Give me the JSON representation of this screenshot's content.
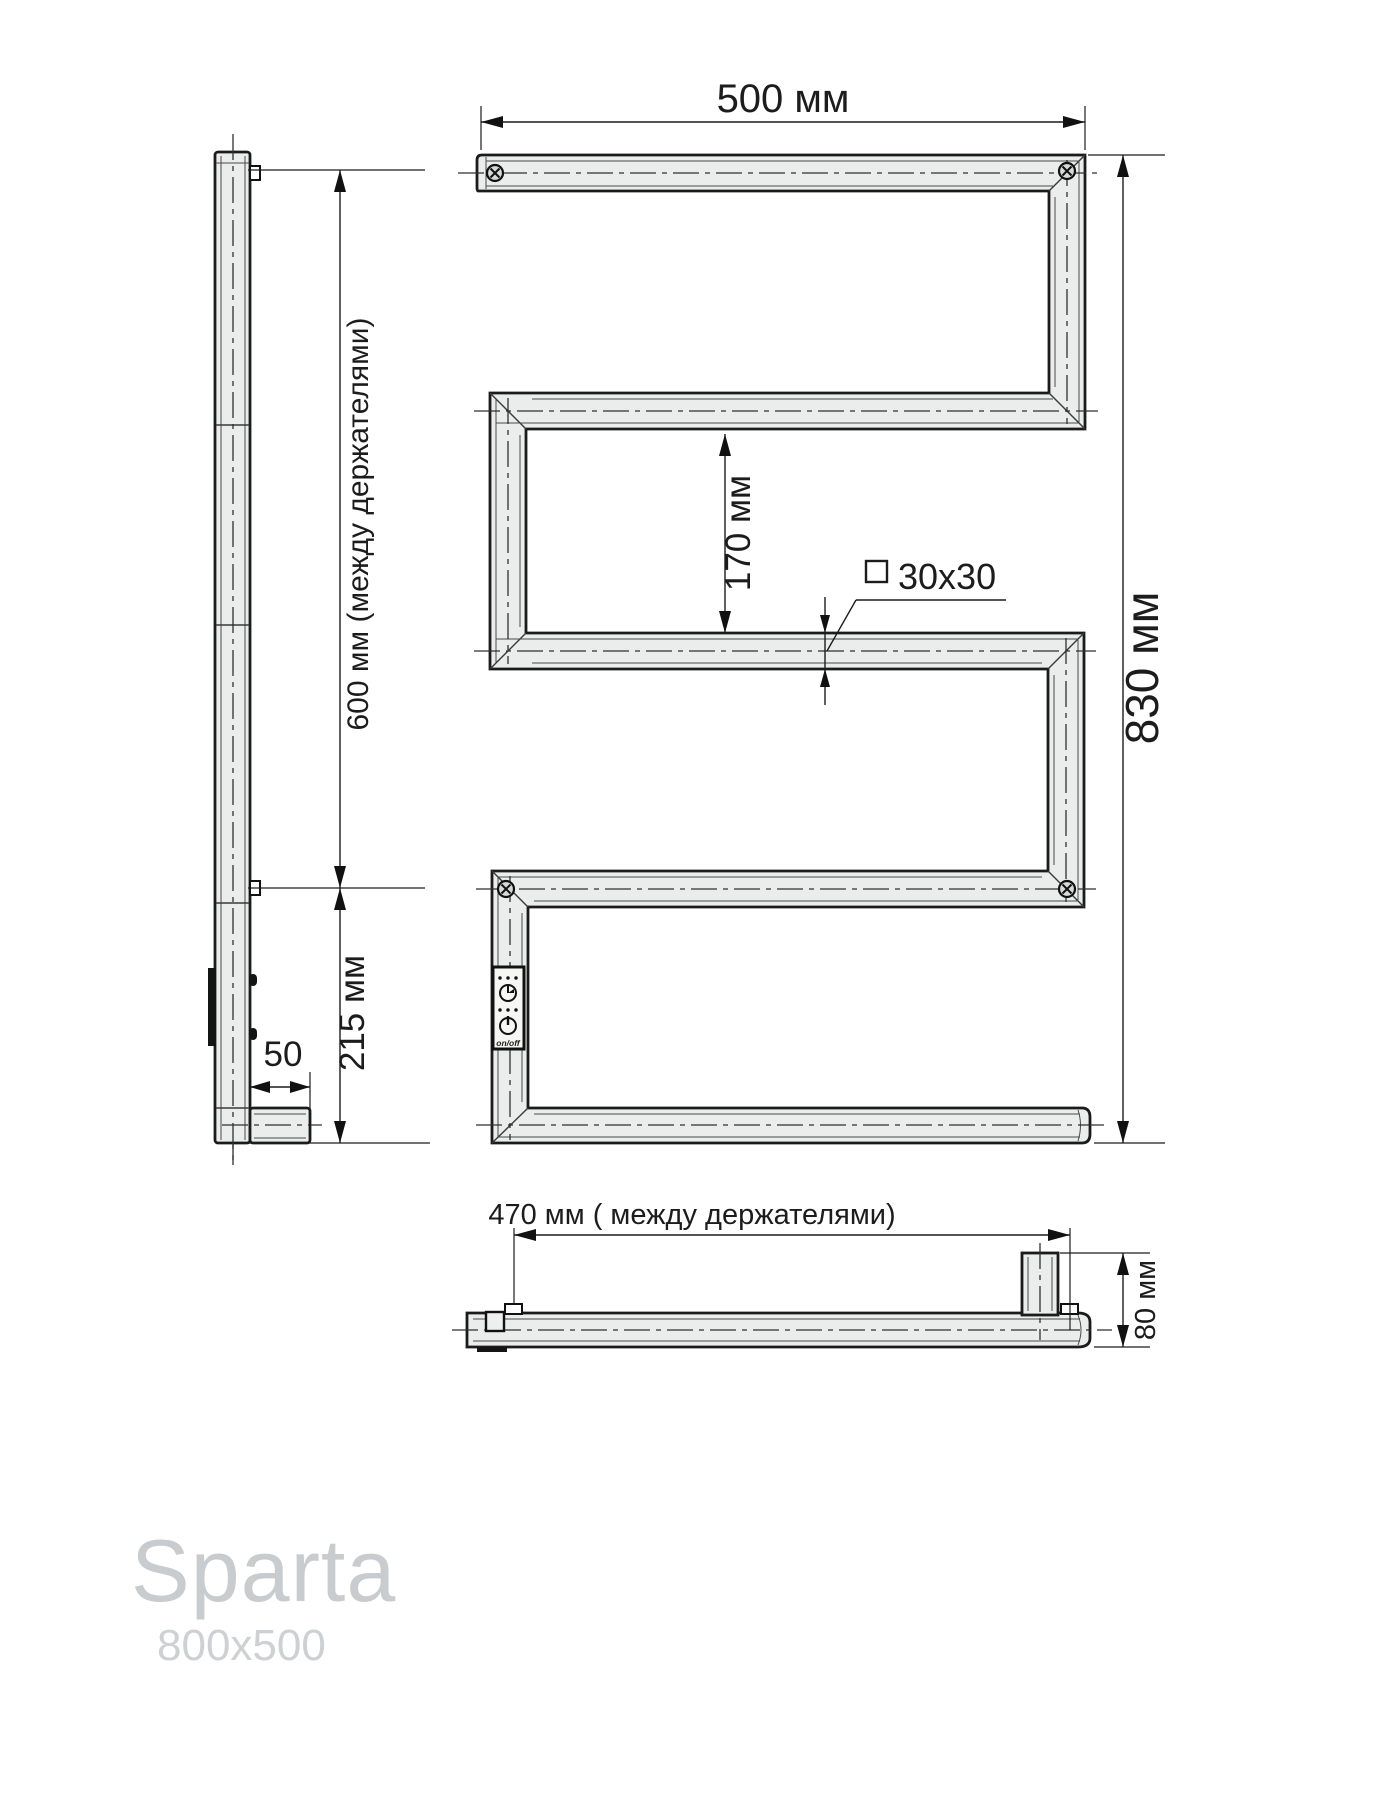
{
  "drawing": {
    "product": {
      "name": "Sparta",
      "size": "800x500"
    },
    "front_view": {
      "top_width_label": "500 мм",
      "overall_height_label": "830 мм",
      "row_gap_label": "170 мм",
      "tube_section_label": "30x30"
    },
    "side_view": {
      "holders_distance_label": "600 мм (между держателями)",
      "bottom_distance_label": "215 мм",
      "foot_offset_label": "50"
    },
    "bottom_view": {
      "holders_distance_label": "470 мм ( между держателями)",
      "depth_label": "80 мм"
    },
    "control_panel": {
      "onoff_label": "on/off"
    },
    "colors": {
      "line": "#1b1b1b",
      "tube_fill": "#ebedec",
      "brand_text": "#c9ccce",
      "brand_sub_text": "#ced1d3"
    }
  }
}
